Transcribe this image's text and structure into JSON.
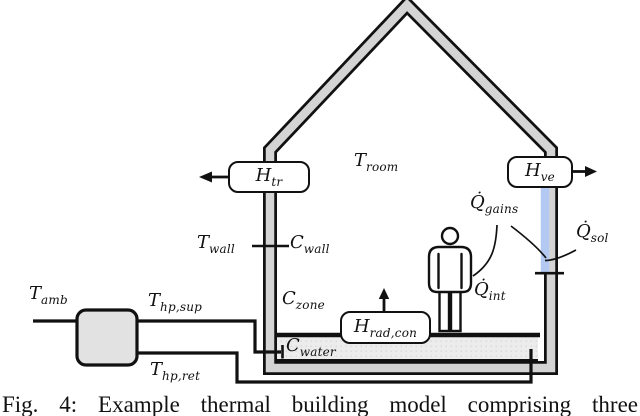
{
  "figure": {
    "caption": "Fig. 4: Example thermal building model comprising three"
  },
  "labels": {
    "t_amb": {
      "base": "T",
      "sub": "amb"
    },
    "t_hp_sup": {
      "base": "T",
      "sub": "hp,sup"
    },
    "t_hp_ret": {
      "base": "T",
      "sub": "hp,ret"
    },
    "t_wall": {
      "base": "T",
      "sub": "wall"
    },
    "c_wall": {
      "base": "C",
      "sub": "wall"
    },
    "c_zone": {
      "base": "C",
      "sub": "zone"
    },
    "c_water": {
      "base": "C",
      "sub": "water"
    },
    "t_room": {
      "base": "T",
      "sub": "room"
    },
    "q_gains": {
      "base": "Q̇",
      "sub": "gains"
    },
    "q_int": {
      "base": "Q̇",
      "sub": "int"
    },
    "q_sol": {
      "base": "Q̇",
      "sub": "sol"
    },
    "h_tr": {
      "base": "H",
      "sub": "tr"
    },
    "h_ve": {
      "base": "H",
      "sub": "ve"
    },
    "h_rad_con": {
      "base": "H",
      "sub": "rad,con"
    }
  },
  "colors": {
    "line": "#111111",
    "wall_fill": "#d4d4d4",
    "water_fill": "#ececec",
    "window_fill": "#b4c9f1",
    "pump_fill": "#e2e2e2"
  }
}
